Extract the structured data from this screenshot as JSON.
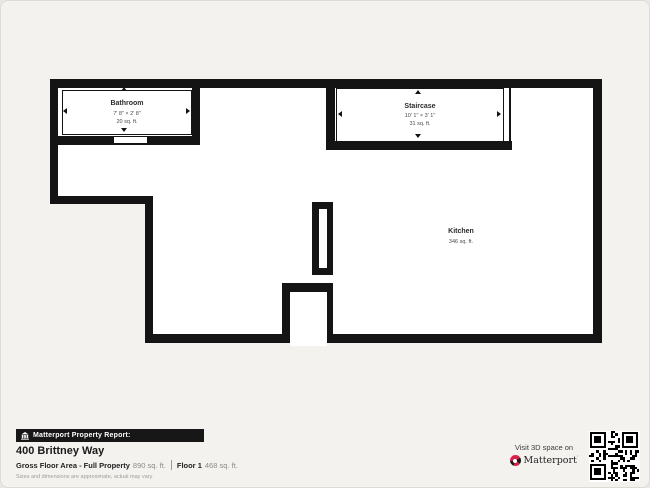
{
  "plan": {
    "rooms": [
      {
        "name": "Bathroom",
        "dims": "7' 8\" × 2' 8\"",
        "area": "20 sq. ft."
      },
      {
        "name": "Staircase",
        "dims": "10' 1\" × 3' 1\"",
        "area": "31 sq. ft."
      },
      {
        "name": "Kitchen",
        "area": "346 sq. ft."
      }
    ]
  },
  "footer": {
    "report_label": "Matterport Property Report:",
    "address": "400 Brittney Way",
    "gross_label": "Gross Floor Area - Full Property",
    "gross_value": "890 sq. ft.",
    "floor_label": "Floor 1",
    "floor_value": "468 sq. ft.",
    "disclaimer": "Sizes and dimensions are approximate, actual may vary",
    "visit_label": "Visit 3D space on",
    "brand": "Matterport"
  },
  "colors": {
    "wall": "#141414",
    "background": "#f4f2ef",
    "accent_red": "#d9224a"
  }
}
